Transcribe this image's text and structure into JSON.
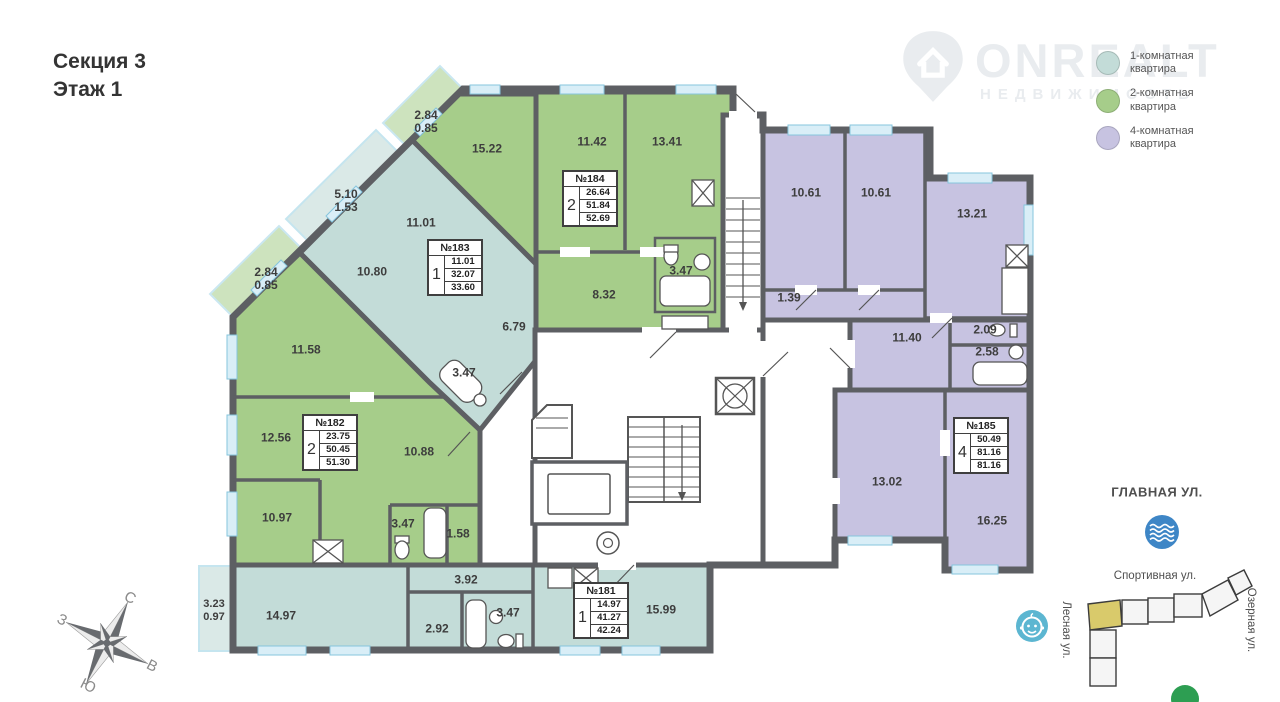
{
  "title": {
    "line1": "Секция 3",
    "line2": "Этаж 1"
  },
  "watermark": {
    "brand": "ONREALT",
    "tagline": "НЕДВИЖИМОСТЬ"
  },
  "legend": {
    "items": [
      {
        "label": "1-комнатная\nквартира"
      },
      {
        "label": "2-комнатная\nквартира"
      },
      {
        "label": "4-комнатная\nквартира"
      }
    ]
  },
  "apartments": [
    {
      "number": "№181",
      "rooms": "1",
      "areas": [
        "14.97",
        "41.27",
        "42.24"
      ]
    },
    {
      "number": "№182",
      "rooms": "2",
      "areas": [
        "23.75",
        "50.45",
        "51.30"
      ]
    },
    {
      "number": "№183",
      "rooms": "1",
      "areas": [
        "11.01",
        "32.07",
        "33.60"
      ]
    },
    {
      "number": "№184",
      "rooms": "2",
      "areas": [
        "26.64",
        "51.84",
        "52.69"
      ]
    },
    {
      "number": "№185",
      "rooms": "4",
      "areas": [
        "50.49",
        "81.16",
        "81.16"
      ]
    }
  ],
  "room_labels": [
    "2.84\n0.85",
    "15.22",
    "11.42",
    "13.41",
    "5.10\n1.53",
    "11.01",
    "10.80",
    "2.84\n0.85",
    "8.32",
    "3.47",
    "6.79",
    "3.47",
    "10.61",
    "10.61",
    "13.21",
    "1.39",
    "11.40",
    "2.09",
    "2.58",
    "11.58",
    "12.56",
    "10.88",
    "10.97",
    "3.47",
    "1.58",
    "13.02",
    "16.25",
    "3.92",
    "14.97",
    "2.92",
    "3.47",
    "15.99",
    "3.23\n0.97"
  ],
  "compass": {
    "north": "С",
    "south": "Ю",
    "west": "З",
    "east": "В"
  },
  "map": {
    "street_top": "ГЛАВНАЯ УЛ.",
    "street_mid": "Спортивная ул.",
    "street_left": "Лесная ул.",
    "street_right": "Озерная ул."
  },
  "colors": {
    "room1": "#c3dcd8",
    "room2": "#a6cd8a",
    "room4": "#c7c3e1",
    "wall": "#5d5f63",
    "window": "#d9eef7",
    "window_border": "#86c5dd",
    "balcony_border": "#9fd4e6",
    "accent_yellow": "#d9ca6b",
    "icon_blue": "#3e86c6",
    "icon_lightblue": "#5cb6d1",
    "icon_green": "#2d9e52"
  }
}
